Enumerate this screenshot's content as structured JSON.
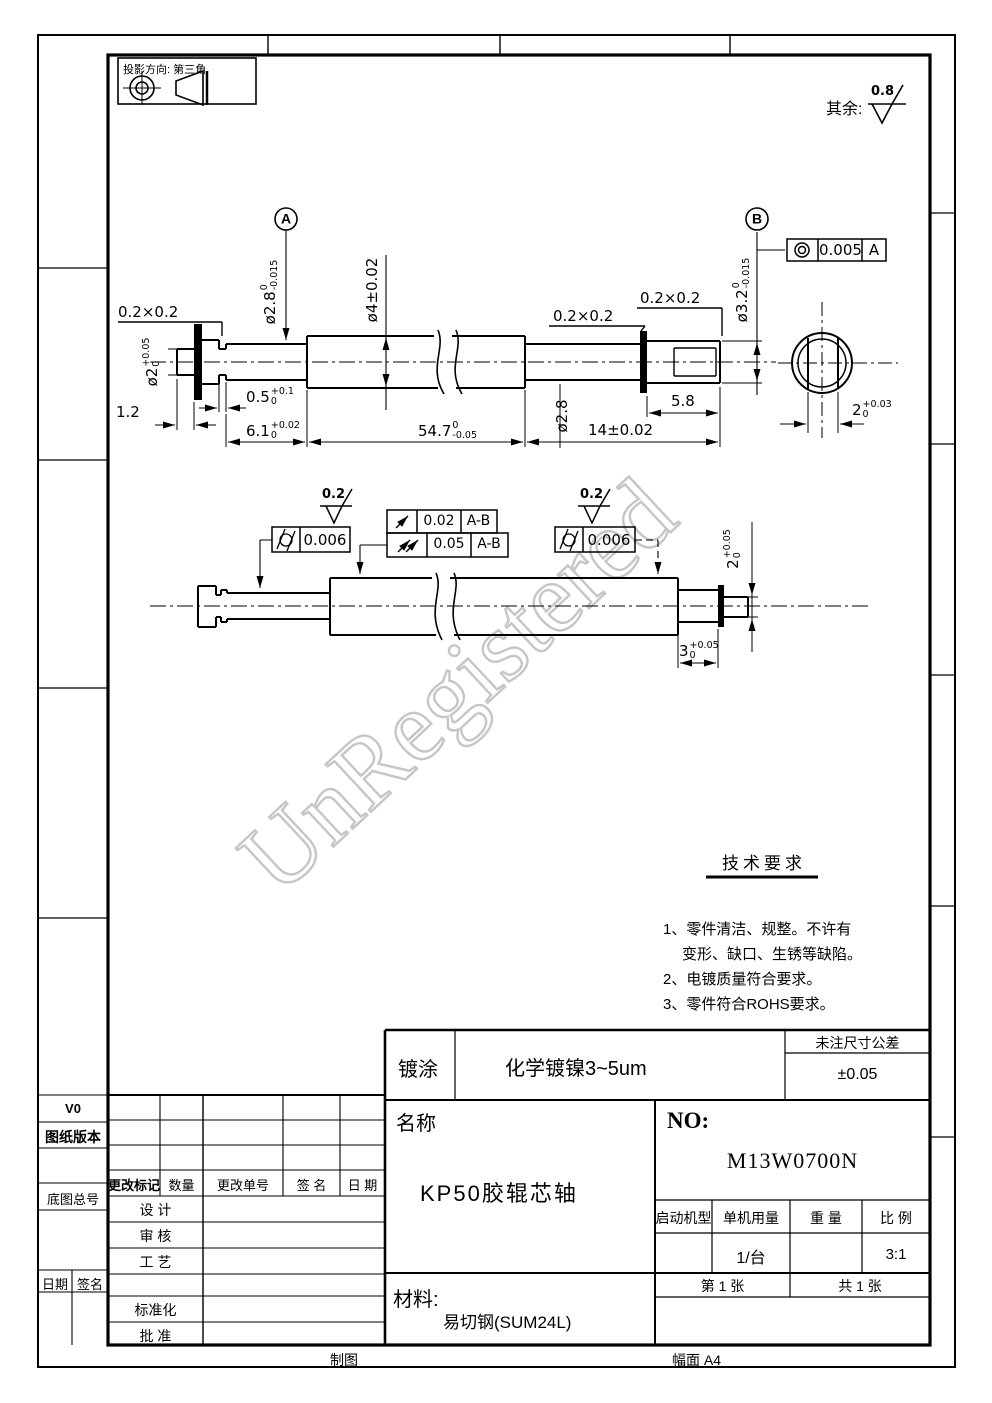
{
  "frame": {
    "projection_label": "投影方向: 第三角",
    "surface_rest_label": "其余:",
    "surface_rest_value": "0.8",
    "bottom_left_label": "制图",
    "bottom_right_label": "幅面 A4"
  },
  "watermark": "UnRegistered",
  "gdt_symbols": {
    "concentricity": "concentricity-icon",
    "cylindricity": "cylindricity-icon",
    "circular_runout": "circular-runout-icon",
    "total_runout": "total-runout-icon",
    "roughness": "surface-roughness-icon"
  },
  "main_view": {
    "chamfer_left": "0.2×0.2",
    "chamfer_mid": "0.2×0.2",
    "chamfer_right": "0.2×0.2",
    "datum_a": "A",
    "datum_b": "B",
    "fcf_concentricity": {
      "value": "0.005",
      "datum": "A"
    },
    "dims": {
      "len_stub": "1.2",
      "groove": {
        "main": "0.5",
        "sup": "+0.1",
        "sub": "0"
      },
      "len_6_1": {
        "main": "6.1",
        "sup": "+0.02",
        "sub": "0"
      },
      "len_54_7": {
        "main": "54.7",
        "sup": "0",
        "sub": "-0.05"
      },
      "len_14": "14±0.02",
      "len_5_8": "5.8",
      "flat_width": {
        "main": "2",
        "sup": "+0.03",
        "sub": "0"
      },
      "dia_2": {
        "main": "ø2",
        "sup": "+0.05",
        "sub": "0"
      },
      "dia_2_8": {
        "main": "ø2.8",
        "sup": "0",
        "sub": "-0.015"
      },
      "dia_4": "ø4±0.02",
      "dia_3_2": {
        "main": "ø3.2",
        "sup": "0",
        "sub": "-0.015"
      },
      "dia_2_8_right": "ø2.8"
    }
  },
  "second_view": {
    "roughness_left": "0.2",
    "roughness_right": "0.2",
    "fcf_cylindricity_left": {
      "value": "0.006"
    },
    "fcf_cylindricity_right": {
      "value": "0.006"
    },
    "fcf_circular_runout": {
      "value": "0.02",
      "datum": "A-B"
    },
    "fcf_total_runout": {
      "value": "0.05",
      "datum": "A-B"
    },
    "dims": {
      "end_width": {
        "main": "2",
        "sup": "+0.05",
        "sub": "0"
      },
      "end_len": {
        "main": "3",
        "sup": "+0.05",
        "sub": "0"
      }
    }
  },
  "tech_requirements": {
    "title": "技术要求",
    "lines": [
      "1、零件清洁、规整。不许有",
      "变形、缺口、生锈等缺陷。",
      "2、电镀质量符合要求。",
      "3、零件符合ROHS要求。"
    ]
  },
  "title_block": {
    "coating_label": "镀涂",
    "coating_value": "化学镀镍3~5um",
    "tolerance_header": "未注尺寸公差",
    "tolerance_value": "±0.05",
    "name_label": "名称",
    "part_name": "KP50胶辊芯轴",
    "no_label": "NO:",
    "drawing_no": "M13W0700N",
    "machine_label": "启动机型",
    "usage_label": "单机用量",
    "weight_label": "重  量",
    "scale_label": "比  例",
    "usage_value": "1/台",
    "scale_value": "3:1",
    "sheet_no": "第  1  张",
    "sheet_total": "共  1  张",
    "material_label": "材料:",
    "material_value": "易切钢(SUM24L)"
  },
  "revision_table": {
    "version": "V0",
    "version_label": "图纸版本",
    "headers": [
      "更改标记",
      "数量",
      "更改单号",
      "签  名",
      "日  期"
    ],
    "base_no_label": "底图总号",
    "rows": [
      "设   计",
      "审   核",
      "工   艺",
      "标准化",
      "批   准"
    ],
    "date_label": "日期",
    "sign_label": "签名"
  }
}
